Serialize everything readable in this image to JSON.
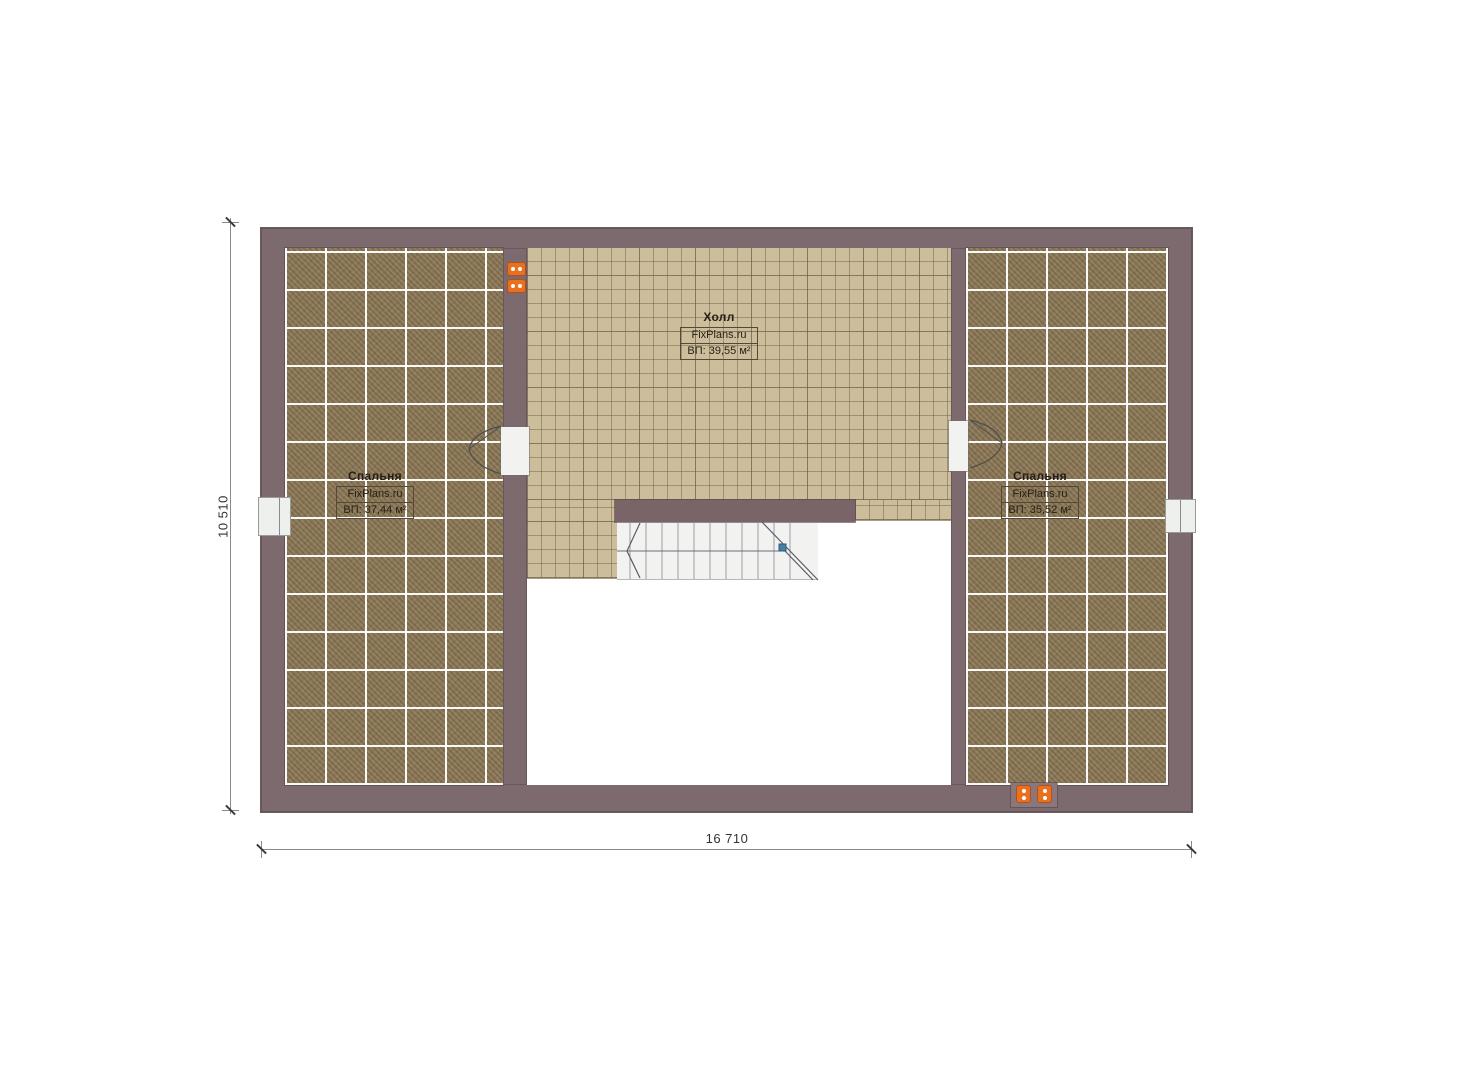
{
  "plan": {
    "title": "floor-plan",
    "rooms": [
      {
        "id": "bedroom-left",
        "name": "Спальня",
        "watermark": "FixPlans.ru",
        "area": "ВП: 37,44 м²",
        "floor": "carpet"
      },
      {
        "id": "hall",
        "name": "Холл",
        "watermark": "FixPlans.ru",
        "area": "ВП: 39,55 м²",
        "floor": "tile"
      },
      {
        "id": "bedroom-right",
        "name": "Спальня",
        "watermark": "FixPlans.ru",
        "area": "ВП: 35,52 м²",
        "floor": "carpet"
      }
    ],
    "dimensions": {
      "vertical": "10 510",
      "horizontal": "16 710"
    },
    "colors": {
      "wall": "#7c6a6e",
      "carpet": "#8d7a58",
      "tile": "#cdbe9b",
      "outlet": "#e8701f",
      "stair_marker": "#4a7fa5"
    }
  }
}
